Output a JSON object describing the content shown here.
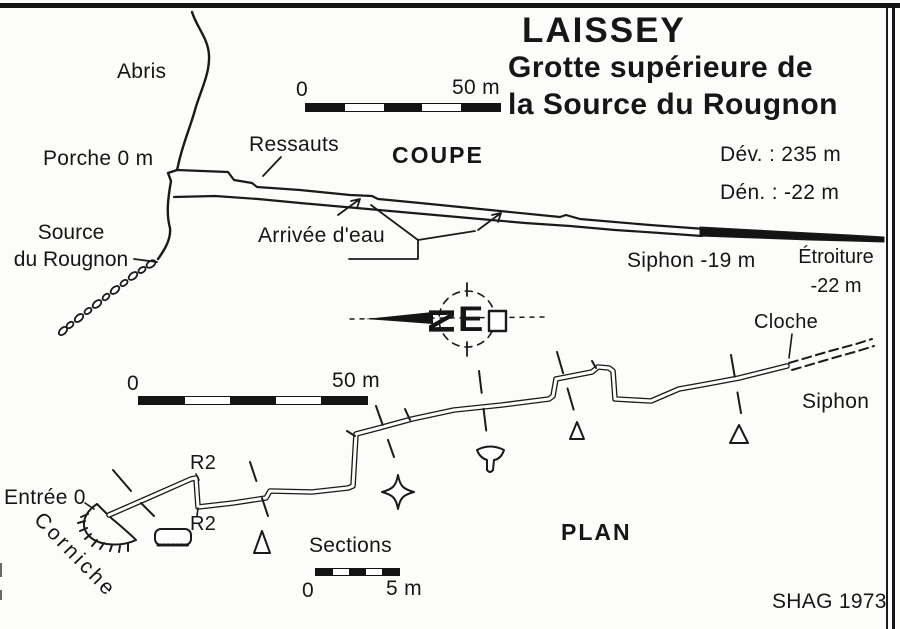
{
  "title": {
    "line1": "LAISSEY",
    "line2": "Grotte supérieure de",
    "line3": "la Source du Rougnon"
  },
  "stats": {
    "development": "Dév. : 235 m",
    "denivelation": "Dén. : -22 m"
  },
  "credit": "SHAG 1973",
  "compass": {
    "letter_n": "N",
    "letter_e": "E"
  },
  "coupe": {
    "heading": "COUPE",
    "scale_zero": "0",
    "scale_max": "50 m",
    "labels": {
      "abris": "Abris",
      "porche": "Porche 0 m",
      "ressauts": "Ressauts",
      "arrivee_eau": "Arrivée d'eau",
      "source_l1": "Source",
      "source_l2": "du Rougnon",
      "siphon": "Siphon -19 m",
      "etroiture": "Étroiture",
      "etroiture_depth": "-22 m"
    }
  },
  "plan": {
    "heading": "PLAN",
    "scale_zero": "0",
    "scale_max": "50 m",
    "labels": {
      "entree": "Entrée 0",
      "corniche": "Corniche",
      "r2_upper": "R2",
      "r2_lower": "R2",
      "cloche": "Cloche",
      "siphon": "Siphon"
    },
    "sections": {
      "label": "Sections",
      "zero": "0",
      "max": "5 m"
    }
  },
  "colors": {
    "ink": "#161616",
    "paper": "#fcfcfa"
  }
}
